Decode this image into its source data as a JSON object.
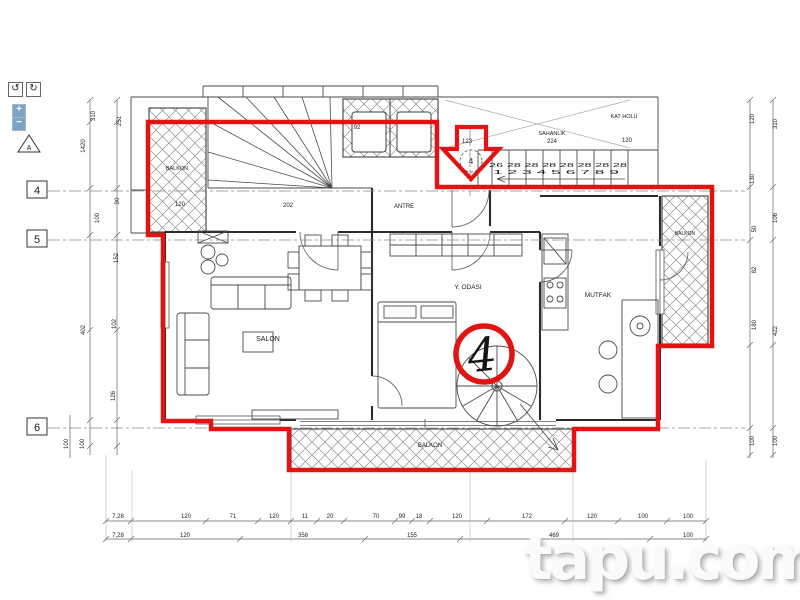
{
  "controls": {
    "rotate_left": "↺",
    "rotate_right": "↻",
    "zoom_in": "+",
    "zoom_out": "−"
  },
  "watermark": "tapu.com",
  "plan": {
    "unit_number": "4",
    "grid_rows": [
      "4",
      "5",
      "6"
    ],
    "grid_col_bubble": "4",
    "section_marker": "A",
    "labels": {
      "salon": "SALON",
      "bedroom": "Y. ODASI",
      "kitchen": "MUTFAK",
      "entry": "ANTRE",
      "balcony_left": "BALKON",
      "balcony_right": "BALKON",
      "balcony_bottom": "BALKON",
      "landing": "SAHANLIK",
      "landing_area": "224",
      "floor_hall": "KAT HOLÜ"
    },
    "stair": {
      "tread_widths": "26 28 28 28 28 28 28 28",
      "tread_numbers": "1 2 3 4 5 6 7 8 9"
    },
    "annotations": {
      "entrance_width": "123",
      "hall_width": "120",
      "stair_width": "202",
      "balcony_width": "120",
      "shaft_width": "92"
    },
    "dims": {
      "left": [
        "310",
        "251",
        "1420",
        "100",
        "90",
        "152",
        "402",
        "102",
        "126",
        "100",
        "100"
      ],
      "right": [
        "120",
        "310",
        "130",
        "106",
        "50",
        "82",
        "180",
        "422",
        "100",
        "100"
      ],
      "bottom_row1": [
        "7,28",
        "120",
        "71",
        "120",
        "11",
        "20",
        "70",
        "99",
        "18",
        "120",
        "172",
        "120",
        "100",
        "100"
      ],
      "bottom_row2": [
        "7,28",
        "120",
        "358",
        "155",
        "469",
        "100"
      ]
    }
  }
}
